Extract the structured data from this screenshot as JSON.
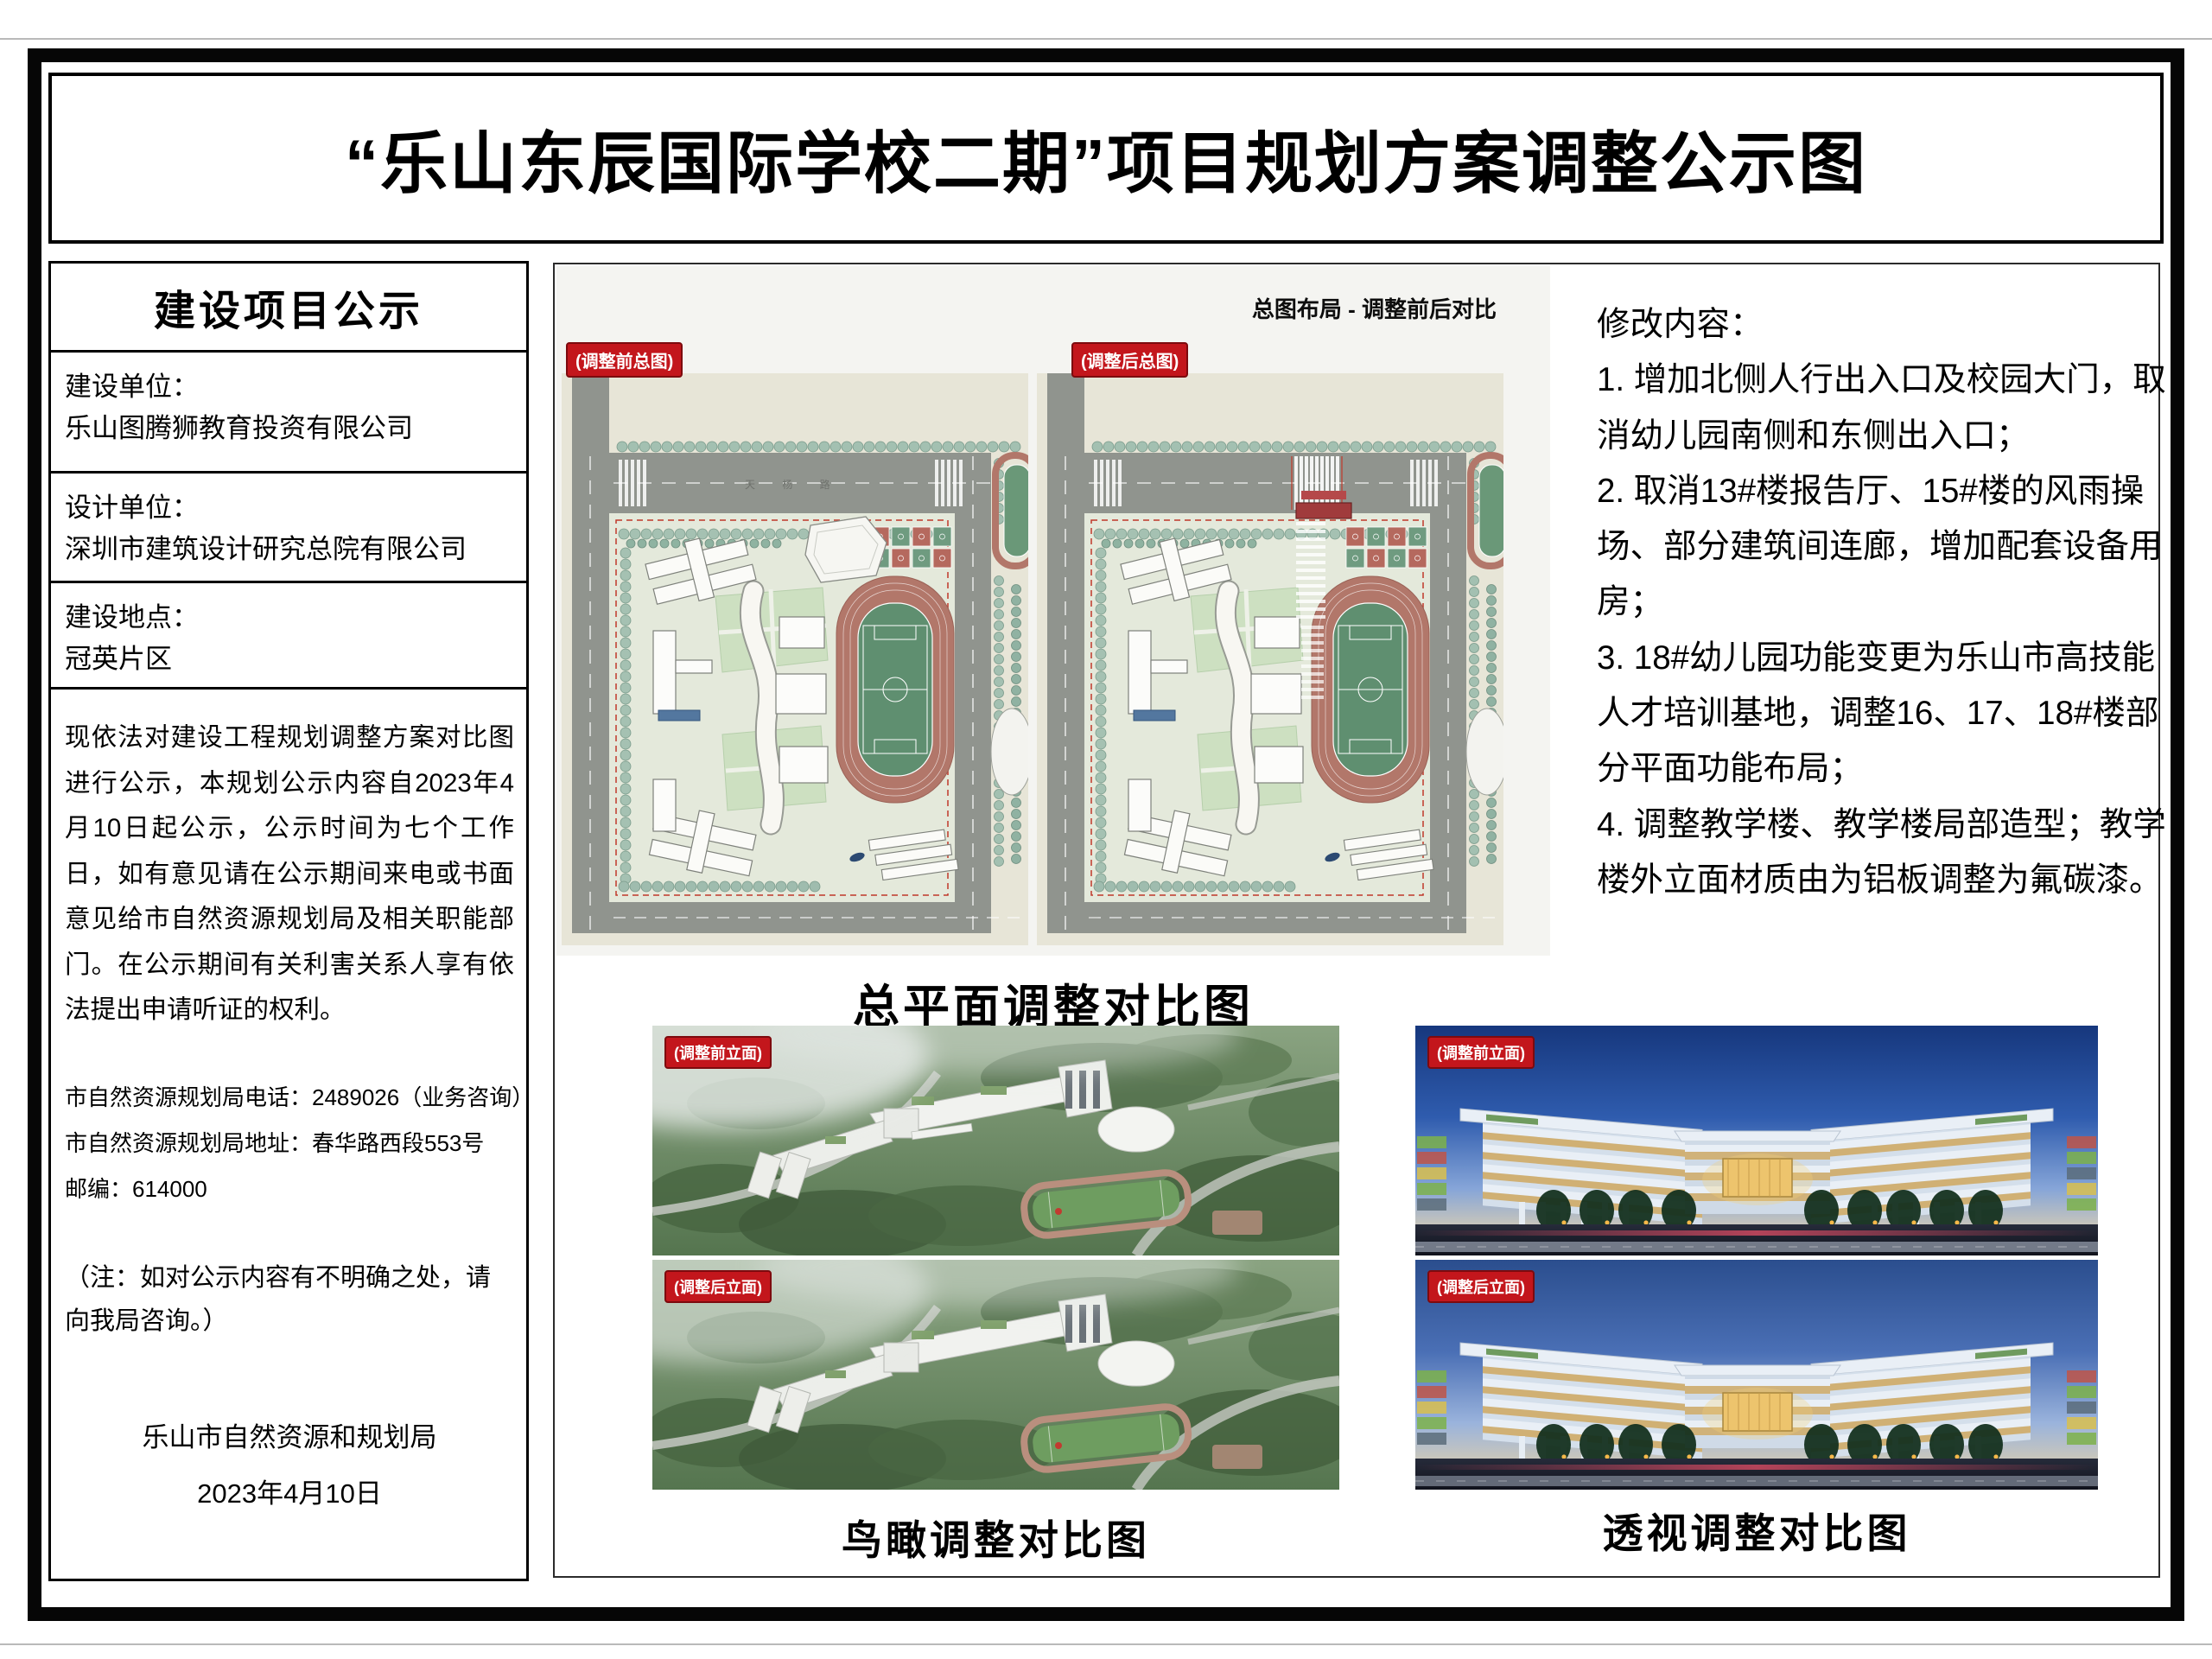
{
  "page": {
    "title": "“乐山东辰国际学校二期”项目规划方案调整公示图"
  },
  "sidebar": {
    "header": "建设项目公示",
    "fields": [
      {
        "label": "建设单位：",
        "value": "乐山图腾狮教育投资有限公司"
      },
      {
        "label": "设计单位：",
        "value": "深圳市建筑设计研究总院有限公司"
      },
      {
        "label": "建设地点：",
        "value": "冠英片区"
      }
    ],
    "notice": "现依法对建设工程规划调整方案对比图进行公示，本规划公示内容自2023年4月10日起公示，公示时间为七个工作日，如有意见请在公示期间来电或书面意见给市自然资源规划局及相关职能部门。在公示期间有关利害关系人享有依法提出申请听证的权利。",
    "phone_line": "市自然资源规划局电话：2489026（业务咨询）",
    "address_line": "市自然资源规划局地址：春华路西段553号",
    "postcode_line": "邮编：614000",
    "note": "（注：如对公示内容有不明确之处，请向我局咨询。）",
    "agency": "乐山市自然资源和规划局",
    "date": "2023年4月10日"
  },
  "plan_panel": {
    "header": "总图布局 - 调整前后对比",
    "badge_before": "(调整前总图)",
    "badge_after": "(调整后总图)",
    "caption": "总平面调整对比图"
  },
  "birdseye": {
    "badge_before": "(调整前立面)",
    "badge_after": "(调整后立面)",
    "caption": "鸟瞰调整对比图"
  },
  "perspective": {
    "badge_before": "(调整前立面)",
    "badge_after": "(调整后立面)",
    "caption": "透视调整对比图"
  },
  "right_column": {
    "heading": "修改内容：",
    "items": [
      "1. 增加北侧人行出入口及校园大门，取消幼儿园南侧和东侧出入口；",
      "2. 取消13#楼报告厅、15#楼的风雨操场、部分建筑间连廊，增加配套设备用房；",
      "3. 18#幼儿园功能变更为乐山市高技能人才培训基地，调整16、17、18#楼部分平面功能布局；",
      "4. 调整教学楼、教学楼局部造型；教学楼外立面材质由为铝板调整为氟碳漆。"
    ]
  },
  "colors": {
    "badge_red": "#c3161c",
    "frame_black": "#060606",
    "panel_gray": "#f4f4f1"
  }
}
